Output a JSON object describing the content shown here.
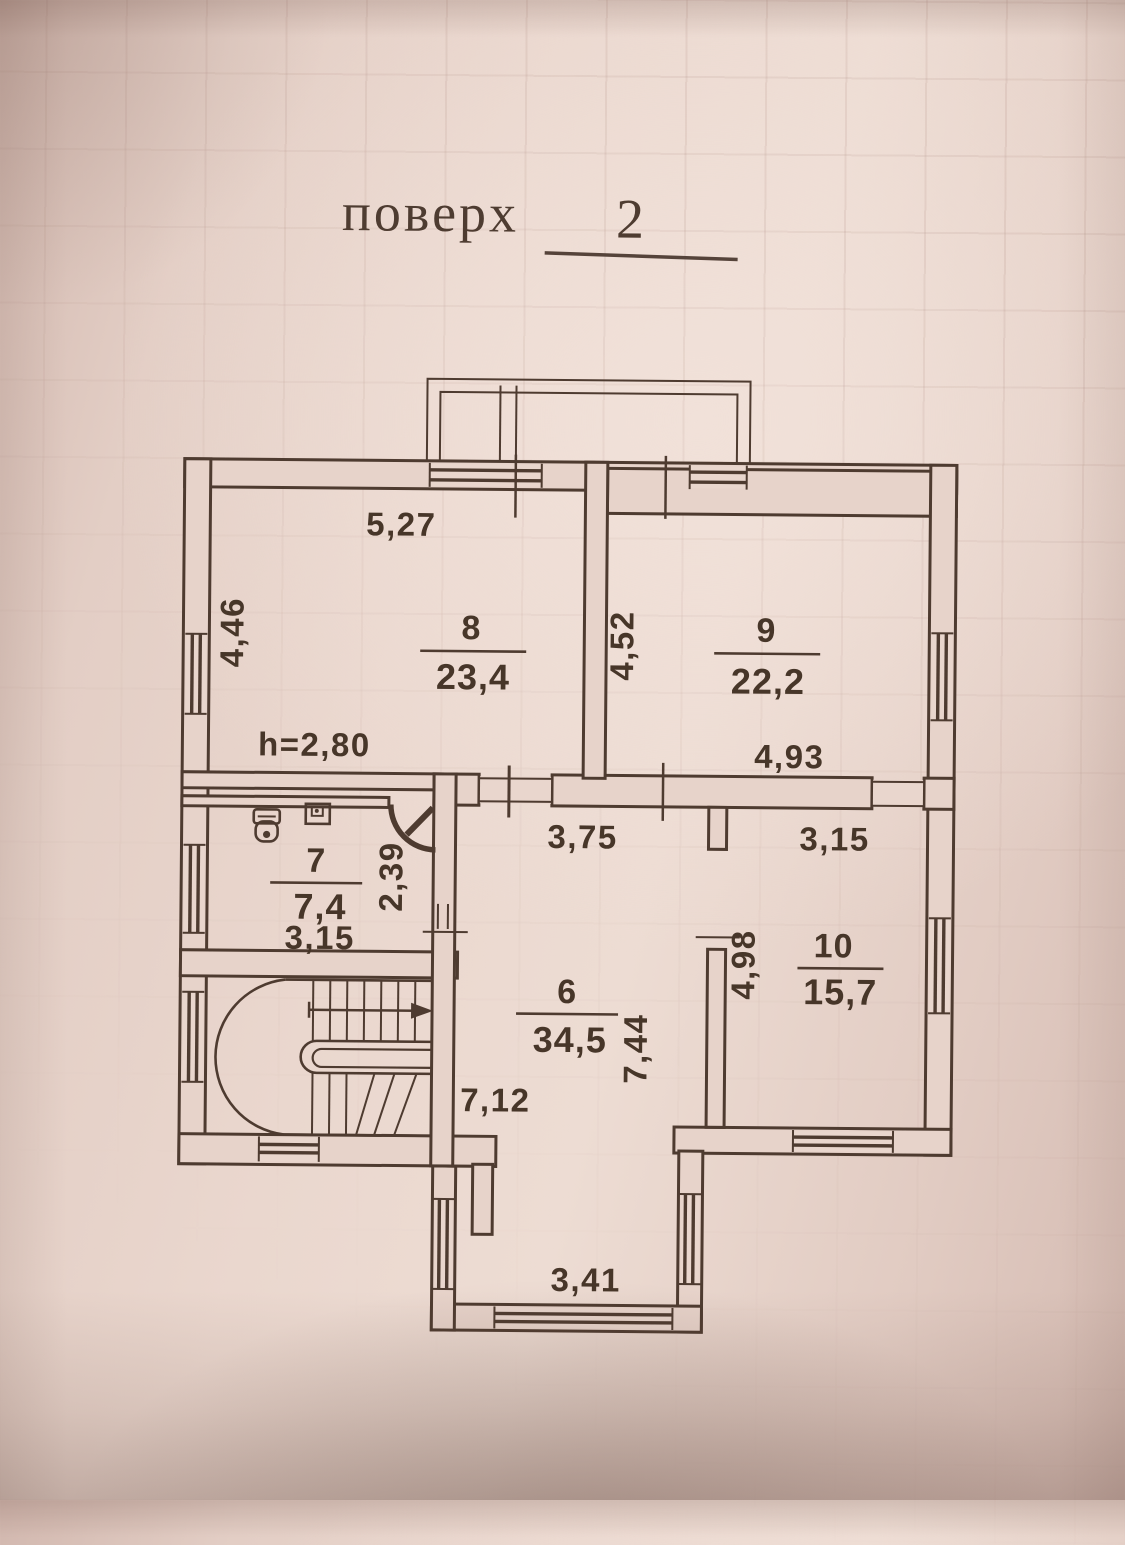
{
  "title": {
    "label": "поверх",
    "number": "2"
  },
  "plan": {
    "ceiling_height": "h=2,80",
    "rooms": {
      "room8": {
        "number": "8",
        "area": "23,4",
        "dim_top": "5,27",
        "dim_left": "4,46"
      },
      "room9": {
        "number": "9",
        "area": "22,2",
        "dim_left": "4,52",
        "dim_bottom": "4,93"
      },
      "room7": {
        "number": "7",
        "area": "7,4",
        "dim_bottom": "3,15",
        "dim_door": "2,39"
      },
      "room6": {
        "number": "6",
        "area": "34,5",
        "dim_top": "3,75",
        "dim_right": "7,44",
        "dim_mid": "7,12",
        "dim_bay": "3,41"
      },
      "room10": {
        "number": "10",
        "area": "15,7",
        "dim_top": "3,15",
        "dim_left": "4,98"
      }
    }
  },
  "icons": {
    "toilet": "toilet-icon",
    "sink": "sink-icon",
    "stairs_arrow": "stairs-up-arrow-icon"
  },
  "colors": {
    "paper": "#e8d4cb",
    "ink": "#4e3b30"
  }
}
